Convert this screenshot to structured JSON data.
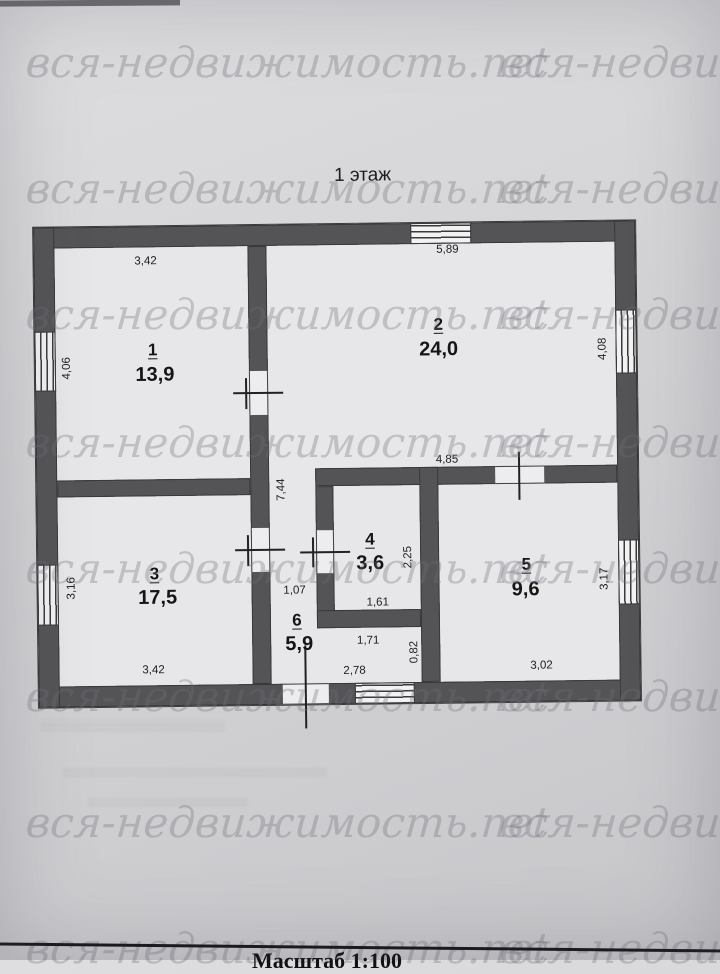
{
  "title": "1 этаж",
  "watermark": "вся-недвижимость.net",
  "scale_label": "Масштаб 1:100",
  "rooms": [
    {
      "number": "1",
      "area": "13,9"
    },
    {
      "number": "2",
      "area": "24,0"
    },
    {
      "number": "3",
      "area": "17,5"
    },
    {
      "number": "4",
      "area": "3,6"
    },
    {
      "number": "5",
      "area": "9,6"
    },
    {
      "number": "6",
      "area": "5,9"
    }
  ],
  "dimensions": {
    "room1_top": "3,42",
    "room2_top": "5,89",
    "room1_left": "4,06",
    "room2_right": "4,08",
    "room3_left": "3,16",
    "room5_right": "3,17",
    "corridor_vertical": "7,44",
    "room2_bottom": "4,85",
    "room4_right": "2,25",
    "room4_bottom": "1,61",
    "hall_top": "1,07",
    "hall_mid": "1,71",
    "hall_right": "0,82",
    "hall_bottom": "2,78",
    "room3_bottom": "3,42",
    "room5_bottom": "3,02"
  },
  "colors": {
    "wall": "#545457",
    "paper": "#d4d4d6",
    "room_fill": "#e7e7e9",
    "ink": "#1c1c1c",
    "watermark": "#6c6c76"
  }
}
